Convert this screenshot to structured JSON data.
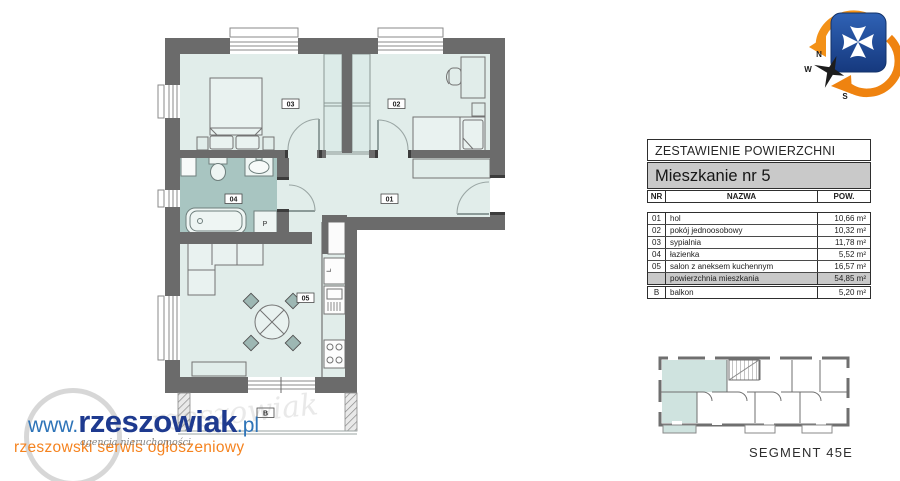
{
  "floor_plan": {
    "rooms": {
      "r01": "01",
      "r02": "02",
      "r03": "03",
      "r04": "04",
      "r05": "05"
    },
    "balcony": "B",
    "washer": "P",
    "fridge": "L"
  },
  "compass": {
    "n": "N",
    "w": "W",
    "s": "S"
  },
  "area_table": {
    "title": "ZESTAWIENIE POWIERZCHNI",
    "apartment": "Mieszkanie nr 5",
    "col_nr": "NR",
    "col_name": "NAZWA",
    "col_area": "POW.",
    "rows": [
      {
        "nr": "01",
        "name": "hol",
        "area": "10,66 m²"
      },
      {
        "nr": "02",
        "name": "pokój jednoosobowy",
        "area": "10,32 m²"
      },
      {
        "nr": "03",
        "name": "sypialnia",
        "area": "11,78 m²"
      },
      {
        "nr": "04",
        "name": "łazienka",
        "area": "5,52 m²"
      },
      {
        "nr": "05",
        "name": "salon z aneksem kuchennym",
        "area": "16,57 m²"
      }
    ],
    "total": {
      "nr": "",
      "name": "powierzchnia mieszkania",
      "area": "54,85 m²"
    },
    "balcony_row": {
      "nr": "B",
      "name": "balkon",
      "area": "5,20 m²"
    }
  },
  "key_plan": {
    "caption": "SEGMENT 45E"
  },
  "watermark": {
    "www": "www.",
    "domain": "rzeszowiak",
    "tld": ".pl",
    "tagline": "rzeszowski serwis ogłoszeniowy",
    "script": "agencja nieruchomości"
  },
  "colors": {
    "wall": "#6b6b6b",
    "room_fill": "#e1edea",
    "bathroom_fill": "#a8c5c1",
    "highlight_teal": "#cfe3df",
    "table_gray": "#c9c9c9",
    "accent_orange": "#f5831f",
    "brand_navy": "#1e3a8f",
    "brand_blue": "#2e74b8"
  }
}
